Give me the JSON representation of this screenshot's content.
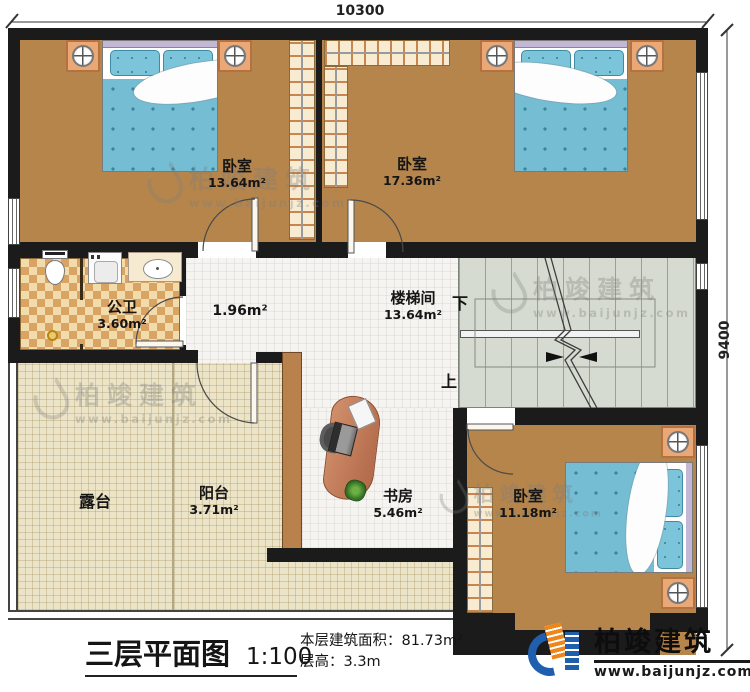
{
  "dimensions": {
    "width": "10300",
    "height": "9400"
  },
  "rooms": {
    "bedroom_tl": {
      "name": "卧室",
      "area": "13.64m²"
    },
    "bedroom_tr": {
      "name": "卧室",
      "area": "17.36m²"
    },
    "bathroom": {
      "name": "公卫",
      "area": "3.60m²"
    },
    "hall": {
      "area": "1.96m²"
    },
    "stairwell": {
      "name": "楼梯间",
      "area": "13.64m²"
    },
    "terrace": {
      "name": "露台"
    },
    "balcony": {
      "name": "阳台",
      "area": "3.71m²"
    },
    "study": {
      "name": "书房",
      "area": "5.46m²"
    },
    "bedroom_br": {
      "name": "卧室",
      "area": "11.18m²"
    }
  },
  "stairs": {
    "down_label": "下",
    "up_label": "上"
  },
  "title_block": {
    "title": "三层平面图",
    "scale": "1:100",
    "area_line": "本层建筑面积：81.73m²",
    "height_line": "层高：3.3m"
  },
  "brand": {
    "name": "柏竣建筑",
    "url": "www.baijunjz.com"
  },
  "watermark": {
    "name": "柏竣建筑",
    "url": "www.baijunjz.com"
  },
  "colors": {
    "wall": "#1b1b1b",
    "wood_floor": "#b5854c",
    "tile_floor": "#f5f4f0",
    "terrace_floor": "#ece4c8",
    "stair_floor": "#d5dbd1",
    "bath_floor": "#d9a364",
    "bed_blue": "#74bdd3",
    "nightstand_orange": "#e9a876",
    "brand_blue": "#1f5fae",
    "brand_orange": "#f08519"
  }
}
